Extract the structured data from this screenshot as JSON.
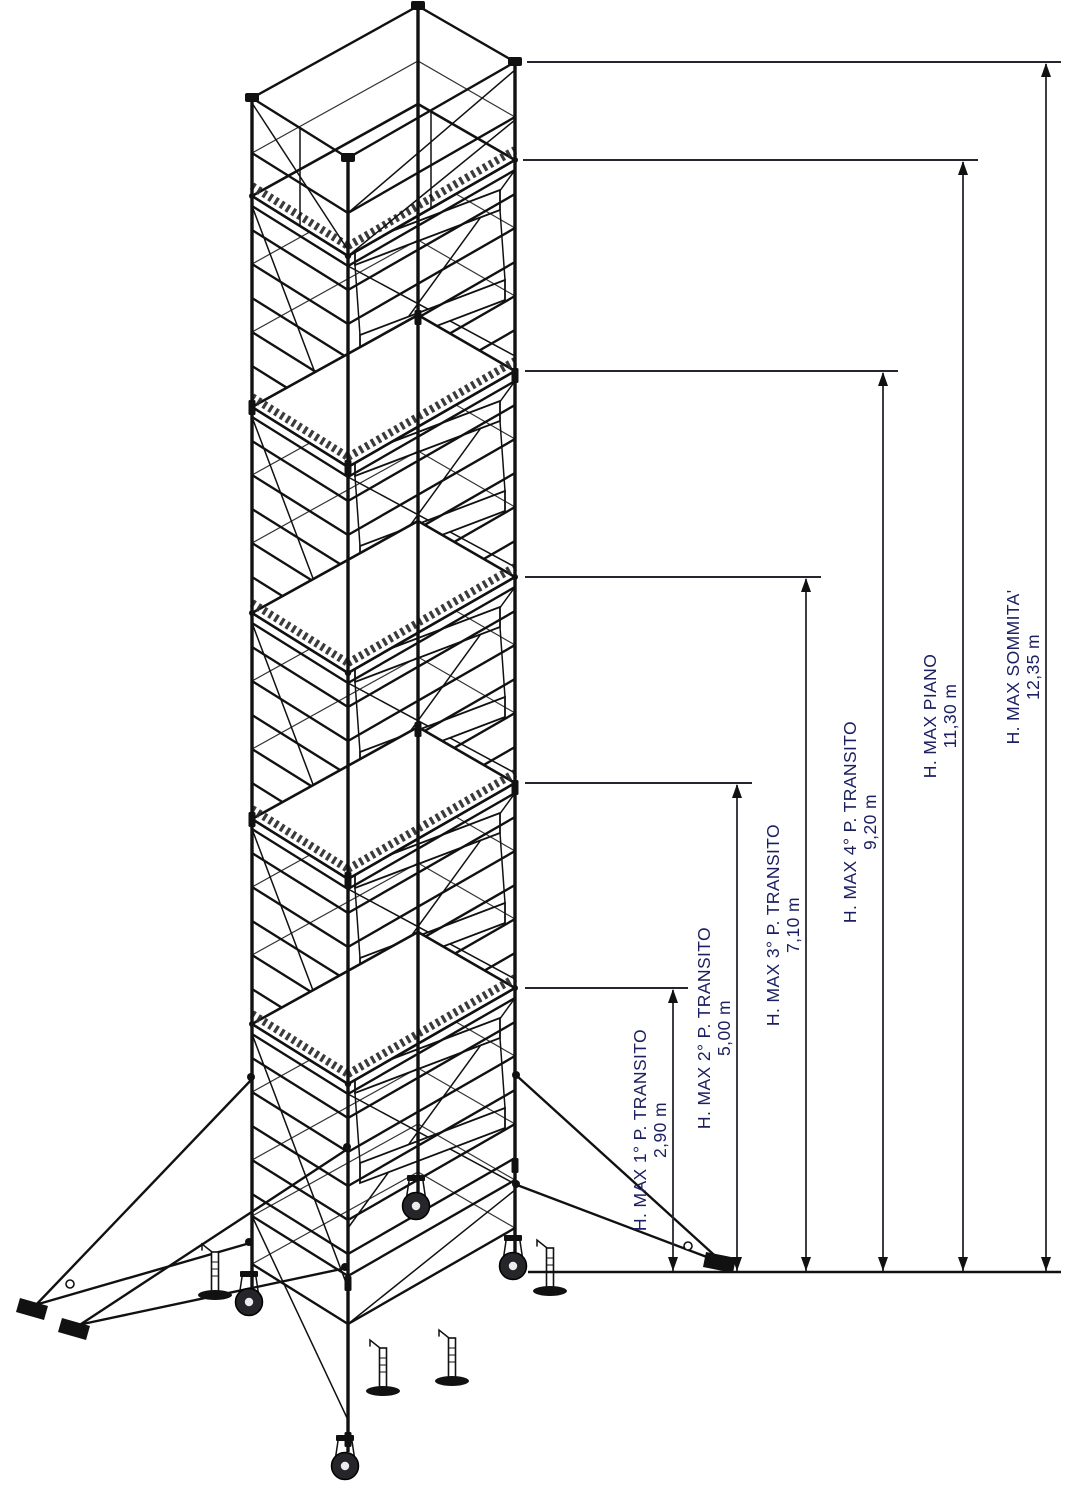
{
  "figure": {
    "type": "isometric technical line drawing",
    "subject": "Mobile scaffold tower (trabattello) with stair platforms, stabilizer outriggers, levelling jacks and casters"
  },
  "dimensions": [
    {
      "id": "transito-1",
      "label": "H. MAX 1° P. TRANSITO",
      "value": "2,90 m",
      "meters": 2.9
    },
    {
      "id": "transito-2",
      "label": "H. MAX 2° P. TRANSITO",
      "value": "5,00 m",
      "meters": 5.0
    },
    {
      "id": "transito-3",
      "label": "H. MAX 3° P. TRANSITO",
      "value": "7,10 m",
      "meters": 7.1
    },
    {
      "id": "transito-4",
      "label": "H. MAX 4° P. TRANSITO",
      "value": "9,20 m",
      "meters": 9.2
    },
    {
      "id": "piano",
      "label": "H. MAX PIANO",
      "value": "11,30 m",
      "meters": 11.3
    },
    {
      "id": "sommita",
      "label": "H. MAX SOMMITA'",
      "value": "12,35 m",
      "meters": 12.35
    }
  ],
  "colors": {
    "ink": "#111111",
    "dimension_line": "#26262e",
    "dimension_text": "#1c2060",
    "background": "#ffffff"
  }
}
